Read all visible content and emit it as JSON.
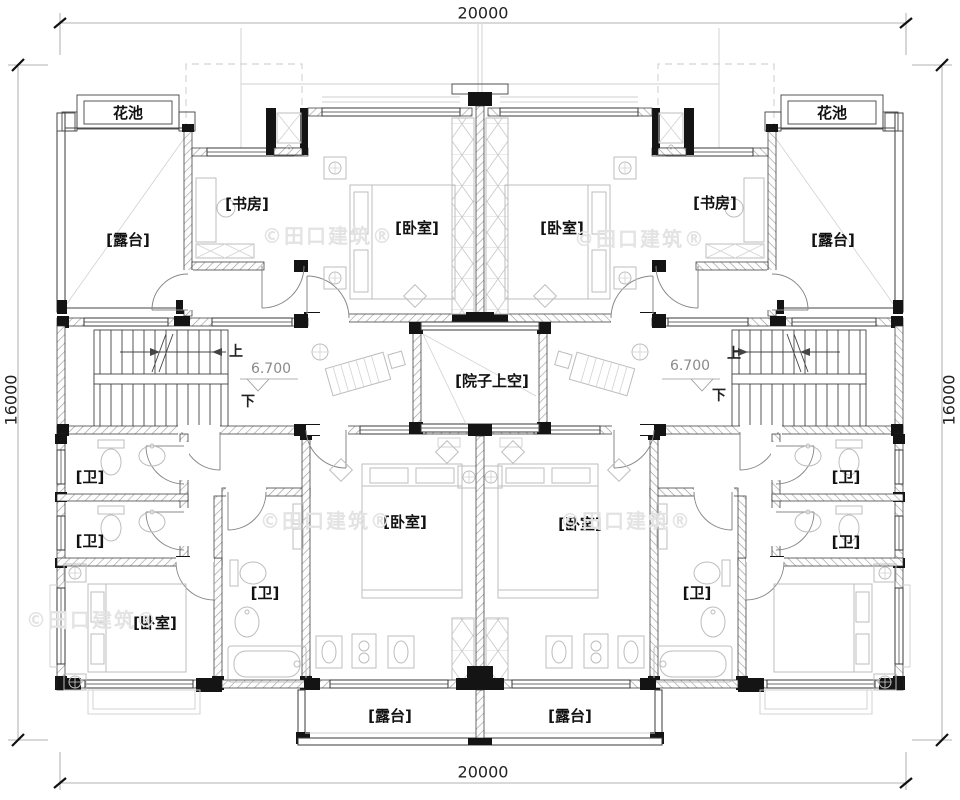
{
  "colors": {
    "ink": "#1a1a1a",
    "wall_hatch": "#9a9a9a",
    "furniture": "#bdbdbd",
    "watermark": "#e3e3e3",
    "dimension_text": "#222222"
  },
  "dimensions": {
    "top": "20000",
    "bottom": "20000",
    "left": "16000",
    "right": "16000"
  },
  "stair": {
    "up": "上",
    "down": "下"
  },
  "elevation": {
    "left": "6.700",
    "right": "6.700"
  },
  "rooms": {
    "flower_bed_left": "花池",
    "flower_bed_right": "花池",
    "terrace_top_left": "[露台]",
    "terrace_top_right": "[露台]",
    "terrace_bottom_left": "[露台]",
    "terrace_bottom_right": "[露台]",
    "study_left": "[书房]",
    "study_right": "[书房]",
    "bedroom_top_left": "[卧室]",
    "bedroom_top_right": "[卧室]",
    "bedroom_center_left": "[卧室]",
    "bedroom_center_right": "[卧室]",
    "bedroom_bottom_left": "[卧室]",
    "bath_left_1": "[卫]",
    "bath_left_2": "[卫]",
    "bath_left_mid": "[卫]",
    "bath_right_mid": "[卫]",
    "bath_right_1": "[卫]",
    "bath_right_2": "[卫]",
    "courtyard": "[院子上空]"
  },
  "watermark": {
    "text": "©田口建筑®"
  }
}
